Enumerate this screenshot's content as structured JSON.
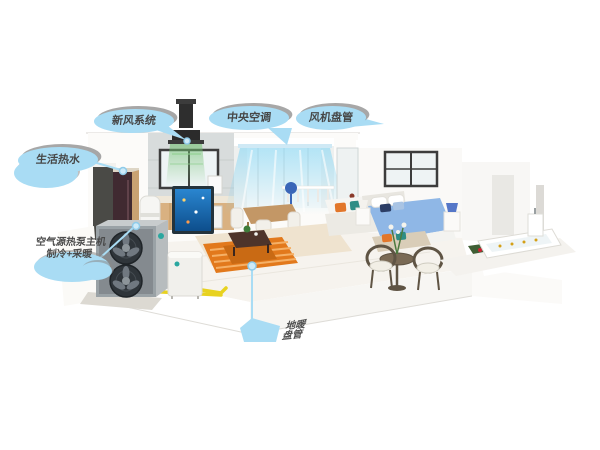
{
  "callouts": {
    "fresh_air": {
      "label": "新风系统"
    },
    "central_ac": {
      "label": "中央空调"
    },
    "fan_coil": {
      "label": "风机盘管"
    },
    "hot_water": {
      "label": "生活热水"
    },
    "heat_pump": {
      "line1": "空气源热泵主机",
      "line2": "制冷+采暖"
    },
    "floor_heating": {
      "line1": "地暖",
      "line2": "盘管"
    }
  },
  "colors": {
    "callout_fill": "#a9dcf4",
    "callout_text": "#474747",
    "pipe_yellow": "#e8d21f",
    "floor_heating_orange": "#e2791c",
    "airflow_blue": "#7dd4f5",
    "fresh_air_green": "#6fbe6f"
  },
  "scene": {
    "components": [
      "ceiling-fresh-air-unit",
      "ac-ceiling-outlet-airflow",
      "outdoor-heat-pump-unit",
      "hydronic-module",
      "water-tank",
      "floor-standing-cabinet",
      "underfloor-heating-coil",
      "yellow-pipes",
      "kitchen",
      "dining-area",
      "aquarium",
      "living-room-sofa",
      "bedroom-bed",
      "patio-chairs",
      "flower-bed",
      "bathtub"
    ]
  }
}
